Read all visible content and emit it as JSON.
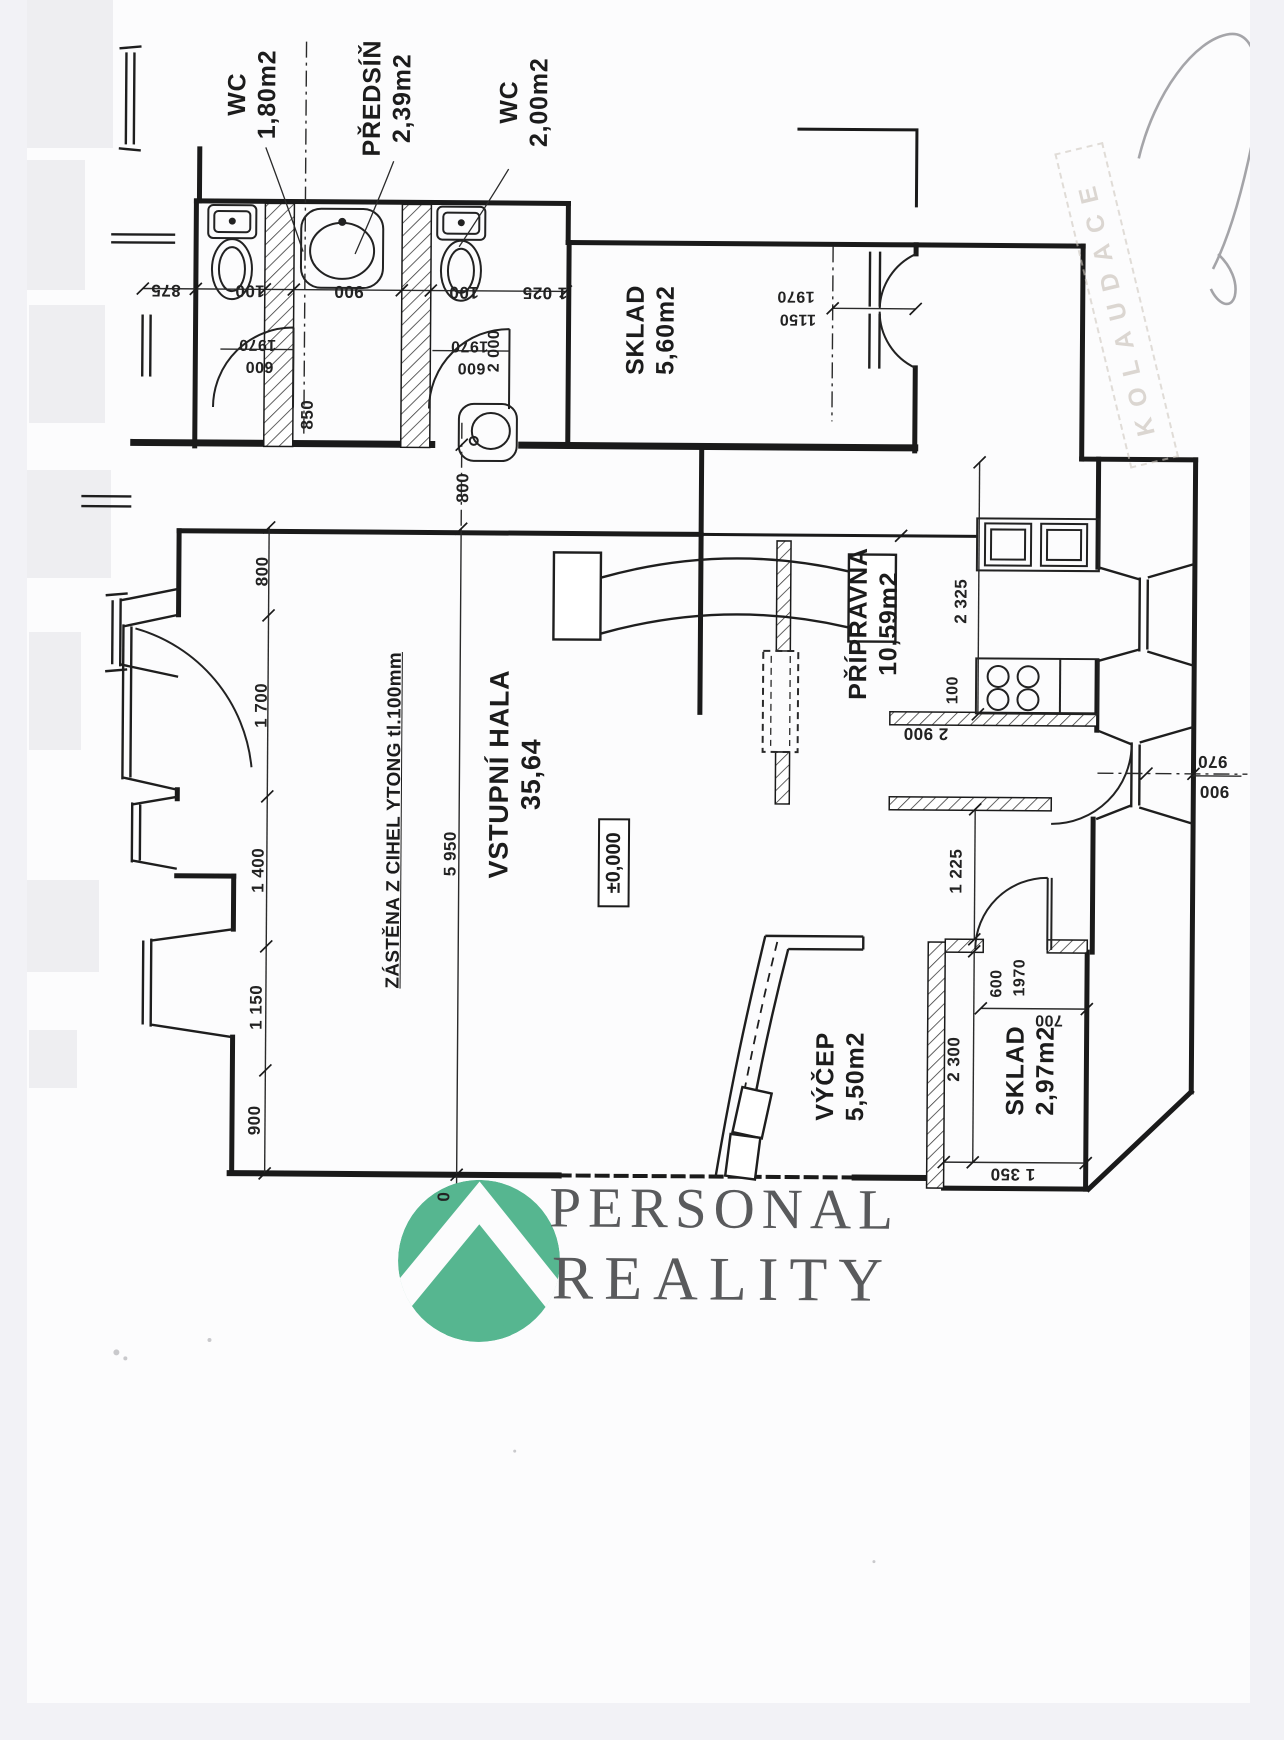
{
  "window": {
    "background": "#f2f2f6",
    "scrollbar_color": "#a5a5aa",
    "page_background": "#fcfcfd"
  },
  "logo": {
    "line1": "PERSONAL",
    "line2": "REALITY",
    "mark_color": "#56B690",
    "text_color": "#595a5c"
  },
  "stamp": {
    "text": "KOLAUDACE"
  },
  "plan": {
    "rooms": [
      {
        "name": "WC",
        "area": "1,80m2"
      },
      {
        "name": "PŘEDSÍŇ",
        "area": "2,39m2"
      },
      {
        "name": "WC",
        "area": "2,00m2"
      },
      {
        "name": "SKLAD",
        "area": "5,60m2"
      },
      {
        "name": "PŘÍPRAVNA",
        "area": "10,59m2"
      },
      {
        "name": "VSTUPNÍ HALA",
        "area": "35,64"
      },
      {
        "name": "VÝČEP",
        "area": "5,50m2"
      },
      {
        "name": "SKLAD",
        "area": "2,97m2"
      }
    ],
    "notes": {
      "partition_note": "ZÁSTĚNA Z CIHEL YTONG tl.100mm",
      "level_mark": "±0,000"
    },
    "dims": {
      "top1": "875",
      "top2": "100",
      "top3": "900",
      "top4": "100",
      "top5": "1 025",
      "wc1_h": "1970",
      "wc1_w": "600",
      "wc2_h": "1970",
      "wc2_w": "600",
      "wc_depth": "2 000",
      "pass": "850",
      "dd_h": "1970",
      "dd_w": "1150",
      "corr": "800",
      "left1": "800",
      "left2": "1 700",
      "left3": "1 400",
      "left4": "1 150",
      "left5": "900",
      "hall_total": "5 950",
      "zero": "0",
      "prep_w": "2 325",
      "prep_b": "2 900",
      "wall100": "100",
      "pass2": "1 225",
      "door_out1": "970",
      "door_out2": "900",
      "skl_door_w": "600",
      "skl_door_h": "1970",
      "skl_off": "700",
      "skl_d": "2 300",
      "skl_w": "1 350"
    }
  }
}
